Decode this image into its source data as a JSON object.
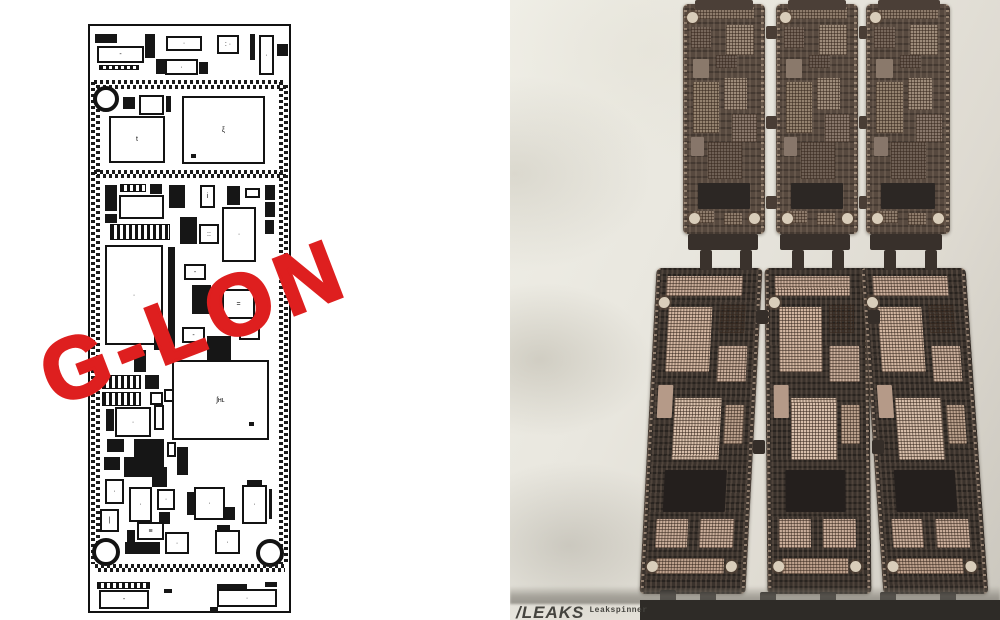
{
  "left_panel": {
    "watermark_text": "G-LON",
    "board": {
      "components": [
        {
          "t": "f",
          "x": 5,
          "y": 8,
          "w": 22,
          "h": 9
        },
        {
          "t": "o",
          "x": 7,
          "y": 20,
          "w": 47,
          "h": 17,
          "g": "-"
        },
        {
          "t": "s",
          "x": 9,
          "y": 39,
          "w": 40,
          "h": 5
        },
        {
          "t": "f",
          "x": 55,
          "y": 8,
          "w": 10,
          "h": 24
        },
        {
          "t": "o",
          "x": 76,
          "y": 10,
          "w": 36,
          "h": 15,
          "g": "·"
        },
        {
          "t": "f",
          "x": 66,
          "y": 33,
          "w": 9,
          "h": 15
        },
        {
          "t": "o",
          "x": 75,
          "y": 33,
          "w": 33,
          "h": 16,
          "g": "·"
        },
        {
          "t": "f",
          "x": 109,
          "y": 36,
          "w": 9,
          "h": 12
        },
        {
          "t": "o",
          "x": 127,
          "y": 9,
          "w": 22,
          "h": 19,
          "g": ": ·"
        },
        {
          "t": "f",
          "x": 160,
          "y": 8,
          "w": 5,
          "h": 26
        },
        {
          "t": "o",
          "x": 169,
          "y": 9,
          "w": 15,
          "h": 40,
          "g": "·"
        },
        {
          "t": "f",
          "x": 187,
          "y": 18,
          "w": 11,
          "h": 12
        },
        {
          "t": "bh",
          "x": 4,
          "y": 54,
          "w": 192,
          "h": 9
        },
        {
          "t": "bv",
          "x": 1,
          "y": 56,
          "w": 9,
          "h": 482
        },
        {
          "t": "bv",
          "x": 189,
          "y": 56,
          "w": 9,
          "h": 482
        },
        {
          "t": "h",
          "x": 3,
          "y": 60,
          "w": 26,
          "h": 26
        },
        {
          "t": "f",
          "x": 33,
          "y": 71,
          "w": 12,
          "h": 12
        },
        {
          "t": "o",
          "x": 49,
          "y": 69,
          "w": 25,
          "h": 20
        },
        {
          "t": "f",
          "x": 76,
          "y": 70,
          "w": 5,
          "h": 16
        },
        {
          "t": "o",
          "x": 92,
          "y": 70,
          "w": 83,
          "h": 68,
          "g": "ξ"
        },
        {
          "t": "f",
          "x": 101,
          "y": 128,
          "w": 5,
          "h": 4
        },
        {
          "t": "o",
          "x": 19,
          "y": 90,
          "w": 56,
          "h": 47,
          "g": "t"
        },
        {
          "t": "bh",
          "x": 4,
          "y": 144,
          "w": 192,
          "h": 8
        },
        {
          "t": "f",
          "x": 15,
          "y": 159,
          "w": 12,
          "h": 26
        },
        {
          "t": "f",
          "x": 15,
          "y": 188,
          "w": 12,
          "h": 9
        },
        {
          "t": "s",
          "x": 30,
          "y": 158,
          "w": 26,
          "h": 8
        },
        {
          "t": "f",
          "x": 60,
          "y": 158,
          "w": 12,
          "h": 10
        },
        {
          "t": "o",
          "x": 29,
          "y": 169,
          "w": 45,
          "h": 24
        },
        {
          "t": "f",
          "x": 79,
          "y": 159,
          "w": 16,
          "h": 23
        },
        {
          "t": "o",
          "x": 110,
          "y": 159,
          "w": 15,
          "h": 23,
          "g": "i"
        },
        {
          "t": "f",
          "x": 137,
          "y": 160,
          "w": 13,
          "h": 19
        },
        {
          "t": "o",
          "x": 155,
          "y": 162,
          "w": 15,
          "h": 10
        },
        {
          "t": "f",
          "x": 175,
          "y": 159,
          "w": 10,
          "h": 15
        },
        {
          "t": "f",
          "x": 175,
          "y": 176,
          "w": 10,
          "h": 15
        },
        {
          "t": "f",
          "x": 175,
          "y": 194,
          "w": 9,
          "h": 14
        },
        {
          "t": "o",
          "x": 132,
          "y": 181,
          "w": 34,
          "h": 55,
          "g": "·"
        },
        {
          "t": "s",
          "x": 20,
          "y": 198,
          "w": 60,
          "h": 16
        },
        {
          "t": "f",
          "x": 90,
          "y": 191,
          "w": 17,
          "h": 27
        },
        {
          "t": "o",
          "x": 109,
          "y": 198,
          "w": 20,
          "h": 20,
          "g": "::"
        },
        {
          "t": "o",
          "x": 15,
          "y": 219,
          "w": 58,
          "h": 100,
          "g": "·"
        },
        {
          "t": "f",
          "x": 78,
          "y": 221,
          "w": 7,
          "h": 100
        },
        {
          "t": "o",
          "x": 94,
          "y": 238,
          "w": 22,
          "h": 16,
          "g": "-"
        },
        {
          "t": "f",
          "x": 102,
          "y": 259,
          "w": 19,
          "h": 29
        },
        {
          "t": "o",
          "x": 132,
          "y": 263,
          "w": 33,
          "h": 30,
          "g": "="
        },
        {
          "t": "f",
          "x": 123,
          "y": 276,
          "w": 8,
          "h": 11
        },
        {
          "t": "o",
          "x": 92,
          "y": 301,
          "w": 23,
          "h": 16,
          "g": "-"
        },
        {
          "t": "o",
          "x": 149,
          "y": 298,
          "w": 21,
          "h": 16,
          "g": "-"
        },
        {
          "t": "f",
          "x": 117,
          "y": 310,
          "w": 24,
          "h": 24
        },
        {
          "t": "f",
          "x": 64,
          "y": 306,
          "w": 14,
          "h": 18
        },
        {
          "t": "f",
          "x": 44,
          "y": 324,
          "w": 12,
          "h": 22
        },
        {
          "t": "s",
          "x": 12,
          "y": 349,
          "w": 39,
          "h": 14
        },
        {
          "t": "s",
          "x": 12,
          "y": 366,
          "w": 39,
          "h": 14
        },
        {
          "t": "f",
          "x": 55,
          "y": 349,
          "w": 14,
          "h": 14
        },
        {
          "t": "o",
          "x": 60,
          "y": 366,
          "w": 13,
          "h": 13
        },
        {
          "t": "o",
          "x": 74,
          "y": 363,
          "w": 10,
          "h": 13
        },
        {
          "t": "o",
          "x": 82,
          "y": 334,
          "w": 97,
          "h": 80,
          "g": "ʃʜʟ"
        },
        {
          "t": "f",
          "x": 159,
          "y": 396,
          "w": 5,
          "h": 4
        },
        {
          "t": "o",
          "x": 25,
          "y": 381,
          "w": 36,
          "h": 30,
          "g": "·"
        },
        {
          "t": "f",
          "x": 16,
          "y": 383,
          "w": 8,
          "h": 22
        },
        {
          "t": "o",
          "x": 64,
          "y": 379,
          "w": 10,
          "h": 25
        },
        {
          "t": "f",
          "x": 17,
          "y": 413,
          "w": 17,
          "h": 13
        },
        {
          "t": "f",
          "x": 44,
          "y": 413,
          "w": 30,
          "h": 23
        },
        {
          "t": "o",
          "x": 77,
          "y": 416,
          "w": 9,
          "h": 15
        },
        {
          "t": "f",
          "x": 87,
          "y": 421,
          "w": 11,
          "h": 28
        },
        {
          "t": "f",
          "x": 14,
          "y": 431,
          "w": 16,
          "h": 13
        },
        {
          "t": "f",
          "x": 34,
          "y": 431,
          "w": 40,
          "h": 20
        },
        {
          "t": "f",
          "x": 62,
          "y": 441,
          "w": 15,
          "h": 20
        },
        {
          "t": "o",
          "x": 15,
          "y": 453,
          "w": 19,
          "h": 25,
          "g": "·"
        },
        {
          "t": "o",
          "x": 10,
          "y": 483,
          "w": 19,
          "h": 23,
          "g": "|"
        },
        {
          "t": "o",
          "x": 39,
          "y": 461,
          "w": 23,
          "h": 35,
          "g": "·"
        },
        {
          "t": "o",
          "x": 67,
          "y": 463,
          "w": 18,
          "h": 21,
          "g": "·"
        },
        {
          "t": "f",
          "x": 69,
          "y": 486,
          "w": 11,
          "h": 12
        },
        {
          "t": "f",
          "x": 97,
          "y": 466,
          "w": 7,
          "h": 23
        },
        {
          "t": "o",
          "x": 104,
          "y": 461,
          "w": 31,
          "h": 33,
          "g": "·"
        },
        {
          "t": "f",
          "x": 135,
          "y": 481,
          "w": 10,
          "h": 13
        },
        {
          "t": "f",
          "x": 157,
          "y": 454,
          "w": 15,
          "h": 7
        },
        {
          "t": "o",
          "x": 152,
          "y": 459,
          "w": 25,
          "h": 39,
          "g": "·"
        },
        {
          "t": "f",
          "x": 179,
          "y": 463,
          "w": 3,
          "h": 30
        },
        {
          "t": "f",
          "x": 37,
          "y": 504,
          "w": 8,
          "h": 14
        },
        {
          "t": "o",
          "x": 47,
          "y": 496,
          "w": 27,
          "h": 18,
          "g": "≡"
        },
        {
          "t": "f",
          "x": 35,
          "y": 516,
          "w": 35,
          "h": 12
        },
        {
          "t": "o",
          "x": 75,
          "y": 506,
          "w": 24,
          "h": 22,
          "g": "·"
        },
        {
          "t": "f",
          "x": 127,
          "y": 499,
          "w": 13,
          "h": 5
        },
        {
          "t": "o",
          "x": 125,
          "y": 504,
          "w": 25,
          "h": 24,
          "g": "·"
        },
        {
          "t": "h",
          "x": 2,
          "y": 512,
          "w": 28,
          "h": 28
        },
        {
          "t": "h",
          "x": 166,
          "y": 513,
          "w": 28,
          "h": 28
        },
        {
          "t": "bh",
          "x": 5,
          "y": 538,
          "w": 190,
          "h": 8
        },
        {
          "t": "s",
          "x": 7,
          "y": 556,
          "w": 53,
          "h": 7
        },
        {
          "t": "o",
          "x": 9,
          "y": 564,
          "w": 50,
          "h": 19,
          "g": "-"
        },
        {
          "t": "f",
          "x": 74,
          "y": 563,
          "w": 8,
          "h": 4
        },
        {
          "t": "f",
          "x": 127,
          "y": 558,
          "w": 30,
          "h": 5
        },
        {
          "t": "f",
          "x": 175,
          "y": 556,
          "w": 12,
          "h": 5
        },
        {
          "t": "o",
          "x": 127,
          "y": 563,
          "w": 60,
          "h": 18,
          "g": "·"
        },
        {
          "t": "f",
          "x": 120,
          "y": 581,
          "w": 8,
          "h": 5
        }
      ]
    }
  },
  "right_panel": {
    "watermark_text": "G-LON",
    "credit_brand": "/LEAKS",
    "credit_sub": "Leakspinner",
    "boards": [
      {
        "row": "top",
        "x": 173,
        "y": 4,
        "w": 82,
        "h": 230,
        "skew": 0
      },
      {
        "row": "top",
        "x": 266,
        "y": 4,
        "w": 82,
        "h": 230,
        "skew": 0
      },
      {
        "row": "top",
        "x": 356,
        "y": 4,
        "w": 84,
        "h": 230,
        "skew": 0
      },
      {
        "row": "bottom",
        "x": 138,
        "y": 268,
        "w": 106,
        "h": 326,
        "skew": -3
      },
      {
        "row": "bottom",
        "x": 256,
        "y": 268,
        "w": 104,
        "h": 326,
        "skew": 0.5
      },
      {
        "row": "bottom",
        "x": 362,
        "y": 268,
        "w": 105,
        "h": 326,
        "skew": 4
      }
    ],
    "chip_layouts": {
      "top": [
        {
          "x": 14,
          "y": 1.5,
          "w": 72,
          "h": 5,
          "c": "#8d7b6b",
          "tex": true
        },
        {
          "x": 52,
          "y": 9,
          "w": 34,
          "h": 13,
          "c": "#9d8b7a",
          "tex": true
        },
        {
          "x": 10,
          "y": 10,
          "w": 24,
          "h": 9,
          "c": "#77675b",
          "tex": true
        },
        {
          "x": 12,
          "y": 24,
          "w": 20,
          "h": 8,
          "c": "#8a796b",
          "tex": false
        },
        {
          "x": 40,
          "y": 22,
          "w": 26,
          "h": 6,
          "c": "#6b5c52",
          "tex": true
        },
        {
          "x": 12,
          "y": 34,
          "w": 32,
          "h": 22,
          "c": "#94826f",
          "tex": true
        },
        {
          "x": 50,
          "y": 32,
          "w": 28,
          "h": 14,
          "c": "#9d8b7a",
          "tex": true
        },
        {
          "x": 60,
          "y": 48,
          "w": 30,
          "h": 12,
          "c": "#87766a",
          "tex": true
        },
        {
          "x": 10,
          "y": 58,
          "w": 16,
          "h": 8,
          "c": "#87766a",
          "tex": false
        },
        {
          "x": 30,
          "y": 60,
          "w": 42,
          "h": 16,
          "c": "#6f6055",
          "tex": true
        },
        {
          "x": 18,
          "y": 78,
          "w": 64,
          "h": 11,
          "c": "#2c2724",
          "tex": false
        },
        {
          "x": 12,
          "y": 90,
          "w": 26,
          "h": 5,
          "c": "#8d7b6b",
          "tex": true
        },
        {
          "x": 50,
          "y": 91,
          "w": 22,
          "h": 5,
          "c": "#8d7b6b",
          "tex": true
        }
      ],
      "bottom": [
        {
          "x": 10,
          "y": 2.5,
          "w": 72,
          "h": 6,
          "c": "#c9ad9a",
          "tex": true
        },
        {
          "x": 13,
          "y": 12,
          "w": 42,
          "h": 20,
          "c": "#d3b7a2",
          "tex": true
        },
        {
          "x": 62,
          "y": 11,
          "w": 24,
          "h": 9,
          "c": "#c0a априори490",
          "tex": true
        },
        {
          "x": 62,
          "y": 24,
          "w": 28,
          "h": 11,
          "c": "#caaf9c",
          "tex": true
        },
        {
          "x": 8,
          "y": 36,
          "w": 14,
          "h": 10,
          "c": "#b59a88",
          "tex": false
        },
        {
          "x": 24,
          "y": 40,
          "w": 44,
          "h": 19,
          "c": "#d8bfab",
          "tex": true
        },
        {
          "x": 72,
          "y": 42,
          "w": 18,
          "h": 12,
          "c": "#bba18d",
          "tex": true
        },
        {
          "x": 18,
          "y": 62,
          "w": 58,
          "h": 13,
          "c": "#241f1d",
          "tex": false
        },
        {
          "x": 12,
          "y": 77,
          "w": 30,
          "h": 9,
          "c": "#c9ad9a",
          "tex": true
        },
        {
          "x": 54,
          "y": 77,
          "w": 32,
          "h": 9,
          "c": "#c9ad9a",
          "tex": true
        },
        {
          "x": 14,
          "y": 89,
          "w": 64,
          "h": 5,
          "c": "#bfa28e",
          "tex": true
        }
      ]
    },
    "hole_layouts": {
      "top": [
        {
          "x": 5,
          "y": 3.5
        },
        {
          "x": 7,
          "y": 91
        },
        {
          "x": 80,
          "y": 91
        }
      ],
      "bottom": [
        {
          "x": 4,
          "y": 9
        },
        {
          "x": 6,
          "y": 90
        },
        {
          "x": 80,
          "y": 90
        }
      ]
    },
    "bridges": [
      {
        "x": 185,
        "y": 0,
        "w": 58,
        "h": 10,
        "c": "#4b3f37"
      },
      {
        "x": 278,
        "y": 0,
        "w": 58,
        "h": 10,
        "c": "#4b3f37"
      },
      {
        "x": 368,
        "y": 0,
        "w": 62,
        "h": 10,
        "c": "#4b3f37"
      },
      {
        "x": 256,
        "y": 26,
        "w": 11,
        "h": 13,
        "c": "#493d35"
      },
      {
        "x": 256,
        "y": 116,
        "w": 11,
        "h": 13,
        "c": "#493d35"
      },
      {
        "x": 256,
        "y": 196,
        "w": 11,
        "h": 13,
        "c": "#493d35"
      },
      {
        "x": 349,
        "y": 26,
        "w": 8,
        "h": 13,
        "c": "#493d35"
      },
      {
        "x": 349,
        "y": 116,
        "w": 8,
        "h": 13,
        "c": "#493d35"
      },
      {
        "x": 349,
        "y": 196,
        "w": 8,
        "h": 13,
        "c": "#493d35"
      },
      {
        "x": 178,
        "y": 234,
        "w": 70,
        "h": 16,
        "c": "#38302b"
      },
      {
        "x": 270,
        "y": 234,
        "w": 70,
        "h": 16,
        "c": "#38302b"
      },
      {
        "x": 360,
        "y": 234,
        "w": 72,
        "h": 16,
        "c": "#38302b"
      },
      {
        "x": 190,
        "y": 250,
        "w": 12,
        "h": 20,
        "c": "#3a322c"
      },
      {
        "x": 230,
        "y": 250,
        "w": 12,
        "h": 20,
        "c": "#3a322c"
      },
      {
        "x": 282,
        "y": 250,
        "w": 12,
        "h": 20,
        "c": "#3a322c"
      },
      {
        "x": 322,
        "y": 250,
        "w": 12,
        "h": 20,
        "c": "#3a322c"
      },
      {
        "x": 374,
        "y": 250,
        "w": 12,
        "h": 20,
        "c": "#3a322c"
      },
      {
        "x": 415,
        "y": 250,
        "w": 12,
        "h": 20,
        "c": "#3a322c"
      },
      {
        "x": 246,
        "y": 310,
        "w": 12,
        "h": 14,
        "c": "#352e29"
      },
      {
        "x": 243,
        "y": 440,
        "w": 12,
        "h": 14,
        "c": "#352e29"
      },
      {
        "x": 358,
        "y": 310,
        "w": 12,
        "h": 14,
        "c": "#352e29"
      },
      {
        "x": 362,
        "y": 440,
        "w": 12,
        "h": 14,
        "c": "#352e29"
      },
      {
        "x": 150,
        "y": 590,
        "w": 16,
        "h": 12,
        "c": "#2b2825"
      },
      {
        "x": 190,
        "y": 592,
        "w": 16,
        "h": 10,
        "c": "#2b2825"
      },
      {
        "x": 250,
        "y": 592,
        "w": 16,
        "h": 10,
        "c": "#2b2825"
      },
      {
        "x": 310,
        "y": 592,
        "w": 16,
        "h": 10,
        "c": "#2b2825"
      },
      {
        "x": 370,
        "y": 592,
        "w": 16,
        "h": 10,
        "c": "#2b2825"
      },
      {
        "x": 430,
        "y": 592,
        "w": 16,
        "h": 10,
        "c": "#2b2825"
      },
      {
        "x": 180,
        "y": 602,
        "w": 16,
        "h": 12,
        "c": "#cfc3a8"
      }
    ]
  }
}
